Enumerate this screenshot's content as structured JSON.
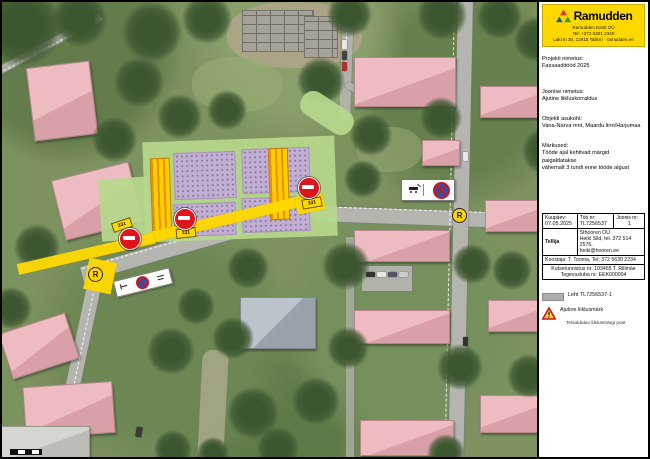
{
  "panel": {
    "brand": {
      "name": "Ramudden",
      "contact_lines": [
        "Ramudden Eesti OÜ",
        "Tel: +372 5301 2340",
        "Laki tn 30, 12915 Tallinn · ramudden.ee"
      ]
    },
    "fields": [
      {
        "label": "Projekti nimetus:",
        "value": "Fassaaditööd 2025"
      },
      {
        "label": "Joonise nimetus:",
        "value": "Ajutine liikluskorraldus"
      },
      {
        "label": "Objekti asukoht:",
        "value": "Vana-Narva mnt, Maardu linn/Harjumaa"
      },
      {
        "label": "Märkused:",
        "lines": [
          "Tööde ajal kehtivad märgid paigaldatakse",
          "vähemalt 3 tundi enne tööde algust"
        ]
      }
    ],
    "table": {
      "date_label": "Kuupäev:",
      "date": "07.05.2025",
      "work_label": "Töö nr:",
      "work": "TL7256537",
      "sheet_label": "Joonis nr:",
      "sheet": "1",
      "client_label": "Tellija",
      "client_lines": [
        "Sthooren OÜ",
        "Heiki Sild, tel. 372 514 2576,",
        "heiki@hooren.ee"
      ],
      "author": "Koostaja: T. Tooma, Tel: 372 5630 2234",
      "cert_lines": [
        "Kutsetunnistus nr: 103465 T. Rillmäe",
        "Tegevusluba nr: EEK000004"
      ]
    },
    "legend": {
      "items": [
        {
          "icon": "work-zone-swatch",
          "text": "Leht TL7256537-1"
        },
        {
          "icon": "warning-triangle",
          "text": "Ajutine liiklusmärk",
          "subtext": "Teisaldatav liiklusmärgi post"
        }
      ]
    }
  },
  "map": {
    "no_entry_plate": "331",
    "node_label": "R"
  },
  "colors": {
    "brand_yellow": "#ffd800",
    "work_zone_yellow": "#ffd900",
    "work_zone_purple": "#c3aed3",
    "overlay_green": "#b6d88c",
    "hatch_orange": "#ec8f00",
    "sign_red": "#e0121a",
    "sign_blue": "#1c5ab5"
  }
}
